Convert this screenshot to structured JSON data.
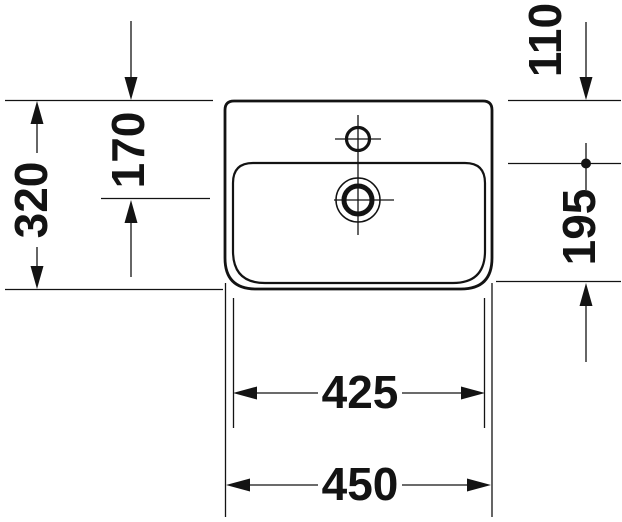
{
  "drawing": {
    "kind": "washbasin-top-view-dimension-drawing"
  },
  "dimensions": {
    "left_outer": "320",
    "left_inner": "170",
    "right_upper": "110",
    "right_lower": "195",
    "bottom_inner": "425",
    "bottom_outer": "450"
  },
  "colors": {
    "ink": "#131313",
    "background": "#ffffff"
  }
}
